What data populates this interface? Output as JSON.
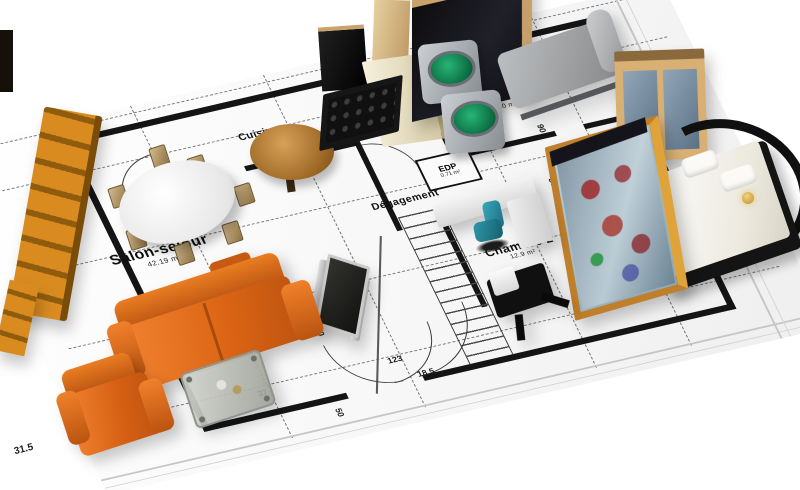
{
  "scene": {
    "type": "3d-apartment-floorplan-render",
    "background": "#ffffff",
    "sheet_color": "#f6f6f6",
    "plan_line_color": "#141414"
  },
  "rooms": [
    {
      "id": "salon",
      "label": "Salon-séjour",
      "area": "42.19 m²"
    },
    {
      "id": "cuisine",
      "label": "Cuisine",
      "area": ""
    },
    {
      "id": "degagement",
      "label": "Dégagement",
      "area": ""
    },
    {
      "id": "edp",
      "label": "EDP",
      "area": "0.71 m²"
    },
    {
      "id": "chambre1",
      "label": "Chambre 1",
      "area": "11.60 m²"
    },
    {
      "id": "chambre2",
      "label": "Chambre 2",
      "area": "12.9 m²"
    }
  ],
  "dimensions": [
    {
      "value": "31.5"
    },
    {
      "value": "37"
    },
    {
      "value": "123"
    },
    {
      "value": "18.5"
    },
    {
      "value": "300"
    },
    {
      "value": "217"
    },
    {
      "value": "50"
    },
    {
      "value": "90"
    },
    {
      "value": "80"
    }
  ],
  "furniture": [
    {
      "name": "orange-sofa"
    },
    {
      "name": "orange-armchair"
    },
    {
      "name": "orange-shelf-unit"
    },
    {
      "name": "coffee-table"
    },
    {
      "name": "dining-table"
    },
    {
      "name": "dining-chairs"
    },
    {
      "name": "round-wood-table"
    },
    {
      "name": "tv-unit"
    },
    {
      "name": "kitchen-hob-counter"
    },
    {
      "name": "kitchen-cabinet"
    },
    {
      "name": "kitchen-tall-panel"
    },
    {
      "name": "range-hood"
    },
    {
      "name": "dark-wardrobe"
    },
    {
      "name": "washing-machines"
    },
    {
      "name": "gray-daybed"
    },
    {
      "name": "tan-wardrobe"
    },
    {
      "name": "glass-display-wardrobe"
    },
    {
      "name": "double-bed"
    },
    {
      "name": "bedside-lamp"
    },
    {
      "name": "office-desk"
    },
    {
      "name": "teal-office-chair"
    },
    {
      "name": "black-chair"
    }
  ],
  "colors": {
    "sofa_orange": "#e8701a",
    "shelf_orange": "#d98b1f",
    "chair_teal": "#2a8fa0",
    "washer_green": "#17935c",
    "table_wood": "#b5722e",
    "wardrobe_tan": "#d9b074",
    "glass_blue": "#9fb8c4",
    "bed_white": "#f5f3ec",
    "frame_black": "#141414"
  }
}
